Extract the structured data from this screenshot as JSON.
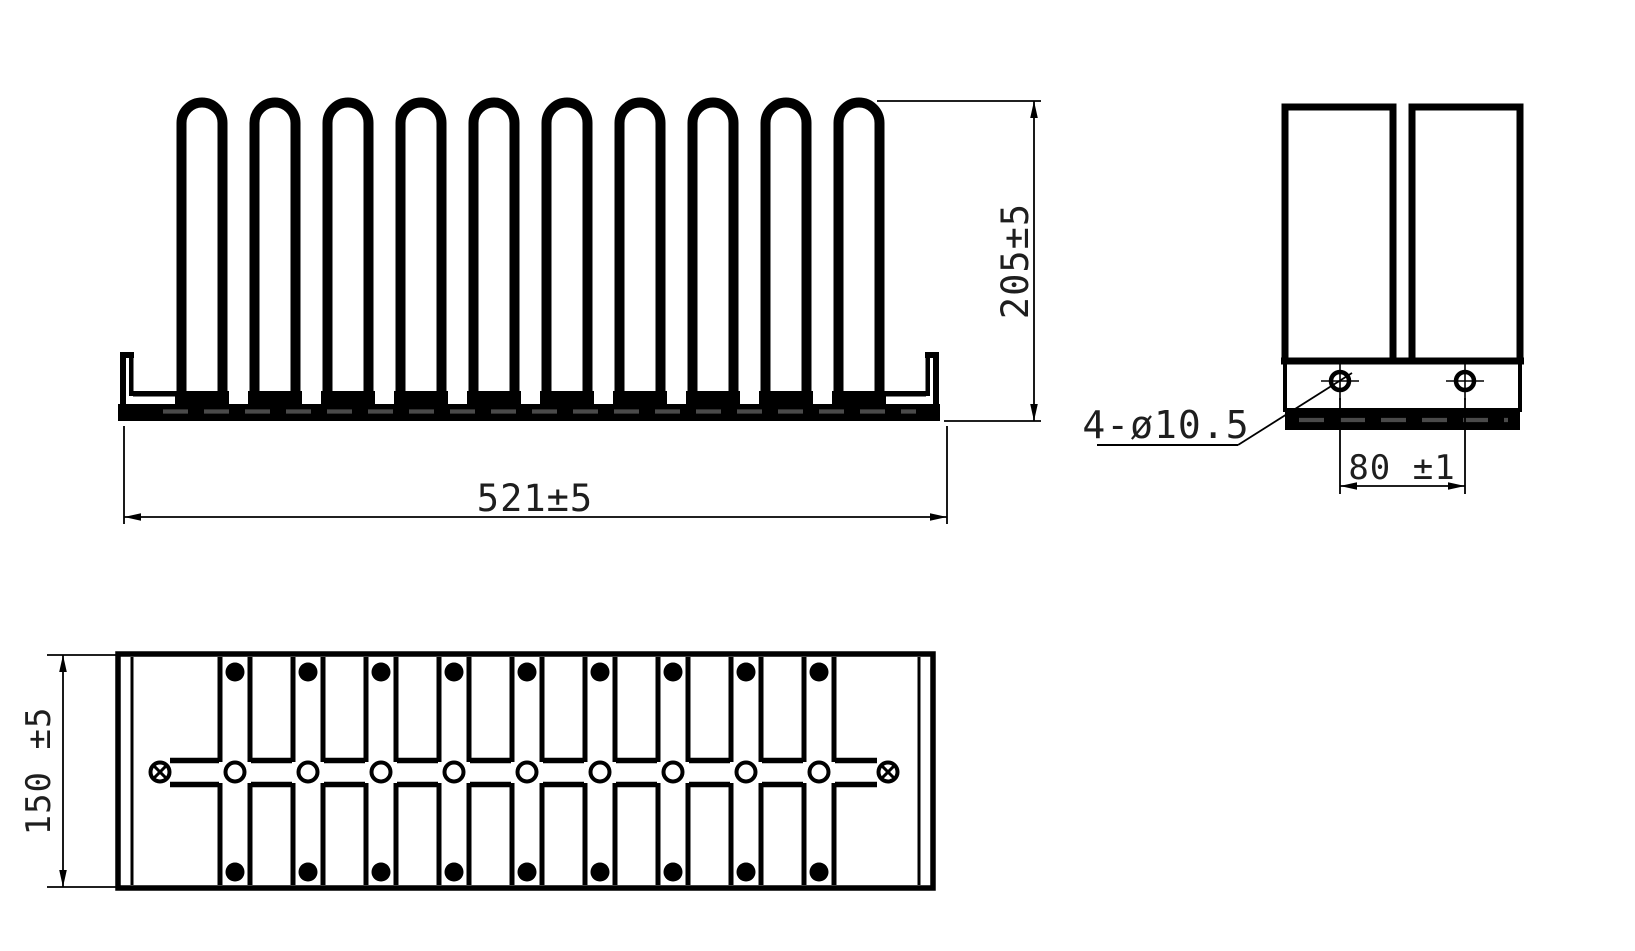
{
  "drawing": {
    "labels": {
      "front_width": "521±5",
      "front_height": "205±5",
      "side_holes": "4-ø10.5",
      "side_hole_spacing": "80 ±1",
      "plan_depth": "150 ±5"
    },
    "dimensions": {
      "overall_width_mm": "521±5",
      "overall_height_mm": "205±5",
      "overall_depth_mm": "150±5",
      "mount_hole_spec": "4-ø10.5",
      "mount_hole_spacing_mm": "80±1"
    },
    "colors": {
      "line": "#000000",
      "hidden_dash": "#4a4a4a",
      "text": "#1e1e1e",
      "background": "#ffffff"
    },
    "geometry": {
      "front": {
        "loop_count": 10,
        "first_loop_cx": 202,
        "loop_pitch": 73,
        "loop_half_inner": 20.5,
        "loop_stroke": 10,
        "loop_arc_cy": 123,
        "loop_bottom_y": 397,
        "pad_y": 391,
        "pad_h": 13,
        "pad_w": 54,
        "bar_x": 118,
        "bar_y": 404,
        "bar_w": 822,
        "bar_h": 17
      },
      "side": {
        "hole_cx": [
          1340,
          1465
        ],
        "hole_cy": 381,
        "hole_r": 9,
        "cross_ext": 19
      },
      "plan": {
        "strip_count": 9,
        "first_strip_cx": 235,
        "strip_pitch": 73,
        "strip_half_w": 15,
        "top_y": 657,
        "bottom_y": 885,
        "band_top_y": 760.5,
        "band_bot_y": 784.5,
        "band_gap_top": 762,
        "band_gap_bot": 783,
        "band_x_start": 170,
        "band_x_end": 877,
        "row_top_cy": 672,
        "row_mid_cy": 772,
        "row_bot_cy": 872,
        "dot_r": 9.5,
        "cross_cx": [
          160,
          888
        ]
      }
    }
  }
}
